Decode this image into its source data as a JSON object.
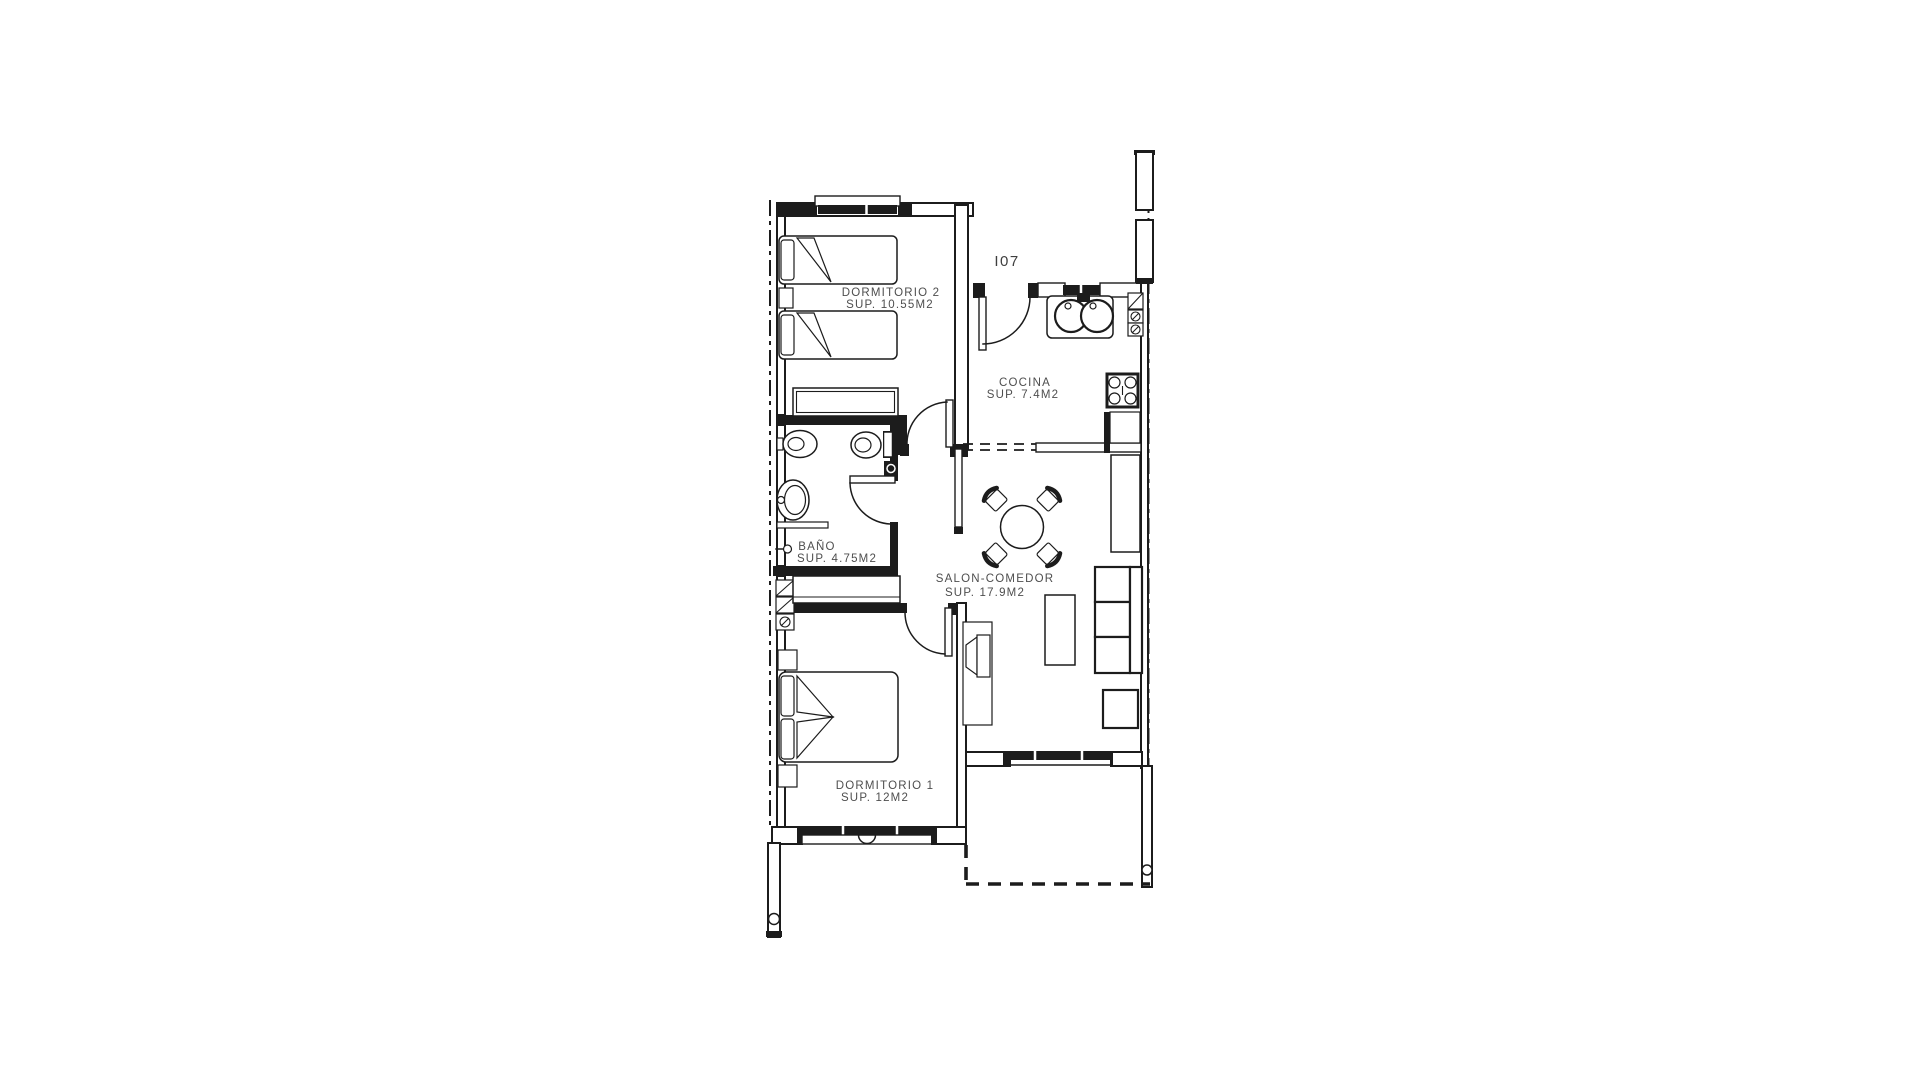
{
  "plan": {
    "background": "#ffffff",
    "line_color": "#1c1c1c",
    "label_color": "#4e4e4e",
    "unit": {
      "label": "I07"
    },
    "rooms": [
      {
        "key": "dormitorio2",
        "name": "DORMITORIO 2",
        "area": "SUP. 10.55M2"
      },
      {
        "key": "cocina",
        "name": "COCINA",
        "area": "SUP. 7.4M2"
      },
      {
        "key": "bano",
        "name": "BAÑO",
        "area": "SUP. 4.75M2"
      },
      {
        "key": "salon",
        "name": "SALON-COMEDOR",
        "area": "SUP. 17.9M2"
      },
      {
        "key": "dormitorio1",
        "name": "DORMITORIO 1",
        "area": "SUP. 12M2"
      }
    ]
  }
}
